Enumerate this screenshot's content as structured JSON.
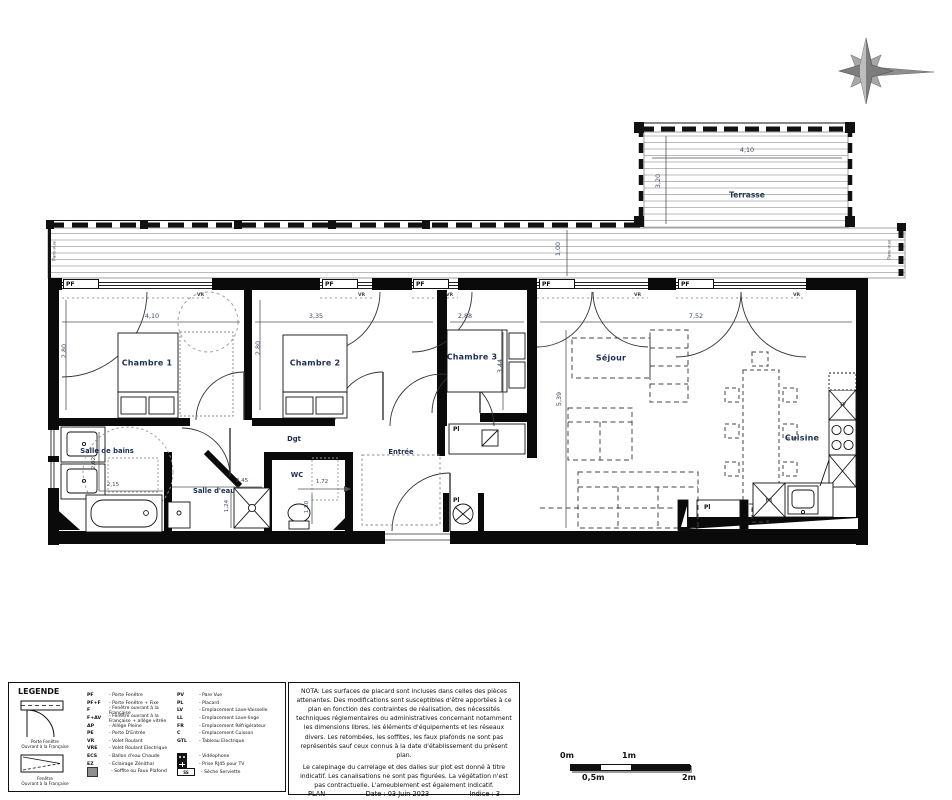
{
  "plan": {
    "terrace": {
      "name": "Terrasse",
      "dim_width": "4,10",
      "dim_depth": "3,20"
    },
    "balcony": {
      "dim_depth": "1,00",
      "screen_label": "Pare-vue"
    },
    "tags": {
      "pf": "PF",
      "vr": "VR",
      "pl": "Pl",
      "fr": "FR",
      "lv": "LV"
    },
    "rooms": {
      "chambre1": {
        "name": "Chambre 1",
        "dim_width": "4,10",
        "dim_height": "2,80"
      },
      "chambre2": {
        "name": "Chambre 2",
        "dim_width": "3,35",
        "dim_height": "2,80"
      },
      "chambre3": {
        "name": "Chambre 3",
        "dim_width": "2,88",
        "dim_height": "3,44"
      },
      "salle_de_bains": {
        "name": "Salle de bains",
        "dim_width": "2,15",
        "dim_height": "2,02"
      },
      "salle_d_eau": {
        "name": "Salle d'eau",
        "dim_width": "2,45",
        "dim_height": "1,24"
      },
      "wc": {
        "name": "WC",
        "dim_width": "1,72",
        "dim_height": "1,50"
      },
      "degagement": {
        "name": "Dgt"
      },
      "entree": {
        "name": "Entrée"
      },
      "sejour": {
        "name": "Séjour",
        "dim_width": "7,52",
        "dim_height": "5,39"
      },
      "cuisine": {
        "name": "Cuisine"
      }
    }
  },
  "legend": {
    "title": "LEGENDE",
    "door_symbol_caption1": "Porte Fenêtre",
    "door_symbol_caption2": "Ouvrant à la Française",
    "window_symbol_caption1": "Fenêtre",
    "window_symbol_caption2": "Ouvrant à la Française",
    "left": [
      {
        "abbr": "PF",
        "label": "- Porte Fenêtre"
      },
      {
        "abbr": "PF+F",
        "label": "- Porte Fenêtre + Fixe"
      },
      {
        "abbr": "F",
        "label": "- Fenêtre  ouvrant à la Française"
      },
      {
        "abbr": "F+AV",
        "label": "- Fenêtre  ouvrant à la Française + allège vitrée"
      },
      {
        "abbr": "AP",
        "label": "- Allège Pleine"
      },
      {
        "abbr": "PE",
        "label": "- Porte D'Entrée"
      },
      {
        "abbr": "VR",
        "label": "- Volet Roulant"
      },
      {
        "abbr": "VRE",
        "label": "- Volet Roulant Electrique"
      },
      {
        "abbr": "ECS",
        "label": "- Ballon d'eau Chaude"
      },
      {
        "abbr": "EZ",
        "label": "- Eclairage Zénithal"
      },
      {
        "abbr": "",
        "icon": "soffite",
        "label": "- Soffite ou Faux Plafond"
      }
    ],
    "right": [
      {
        "abbr": "PV",
        "label": "- Pare Vue"
      },
      {
        "abbr": "PL",
        "label": "- Placard"
      },
      {
        "abbr": "LV",
        "label": "- Emplacement Lave-Vaisselle"
      },
      {
        "abbr": "LL",
        "label": "- Emplacement Lave-linge"
      },
      {
        "abbr": "FR",
        "label": "- Emplacement Réfrigérateur"
      },
      {
        "abbr": "C",
        "label": "- Emplacement Cuisson"
      },
      {
        "abbr": "GTL",
        "label": "- Tableau Electrique"
      },
      {
        "abbr": "",
        "icon": "videophone",
        "label": "- Vidéophone",
        "gap": true
      },
      {
        "abbr": "",
        "icon": "rj45",
        "label": "- Prise RJ45 pour TV"
      },
      {
        "abbr": "SS",
        "icon": "seche",
        "label": "- Sèche Serviette"
      }
    ]
  },
  "nota": {
    "para1": "NOTA: Les surfaces de placard sont incluses dans celles des pièces attenantes. Des modifications sont susceptibles d'être apportées à ce plan en fonction des contraintes de réalisation, des nécessités techniques réglementaires ou administratives concernant notamment les dimensions libres, les éléments d'équipements et les réseaux divers. Les retombées, les soffites, les faux plafonds ne sont pas représentés sauf ceux connus à la date d'établissement du présent plan.",
    "para2": "Le calepinage du carrelage et des dalles sur plot est donné à titre indicatif. Les canalisations ne sont pas figurées. La végétation n'est pas contractuelle. L'ameublement est également indicatif."
  },
  "title_block": {
    "plan_label": "PLAN",
    "date_label": "Date : 03 Juin 2023",
    "indice_label": "Indice : 3"
  },
  "scalebar": {
    "t0": "0m",
    "t05": "0,5m",
    "t1": "1m",
    "t2": "2m"
  }
}
